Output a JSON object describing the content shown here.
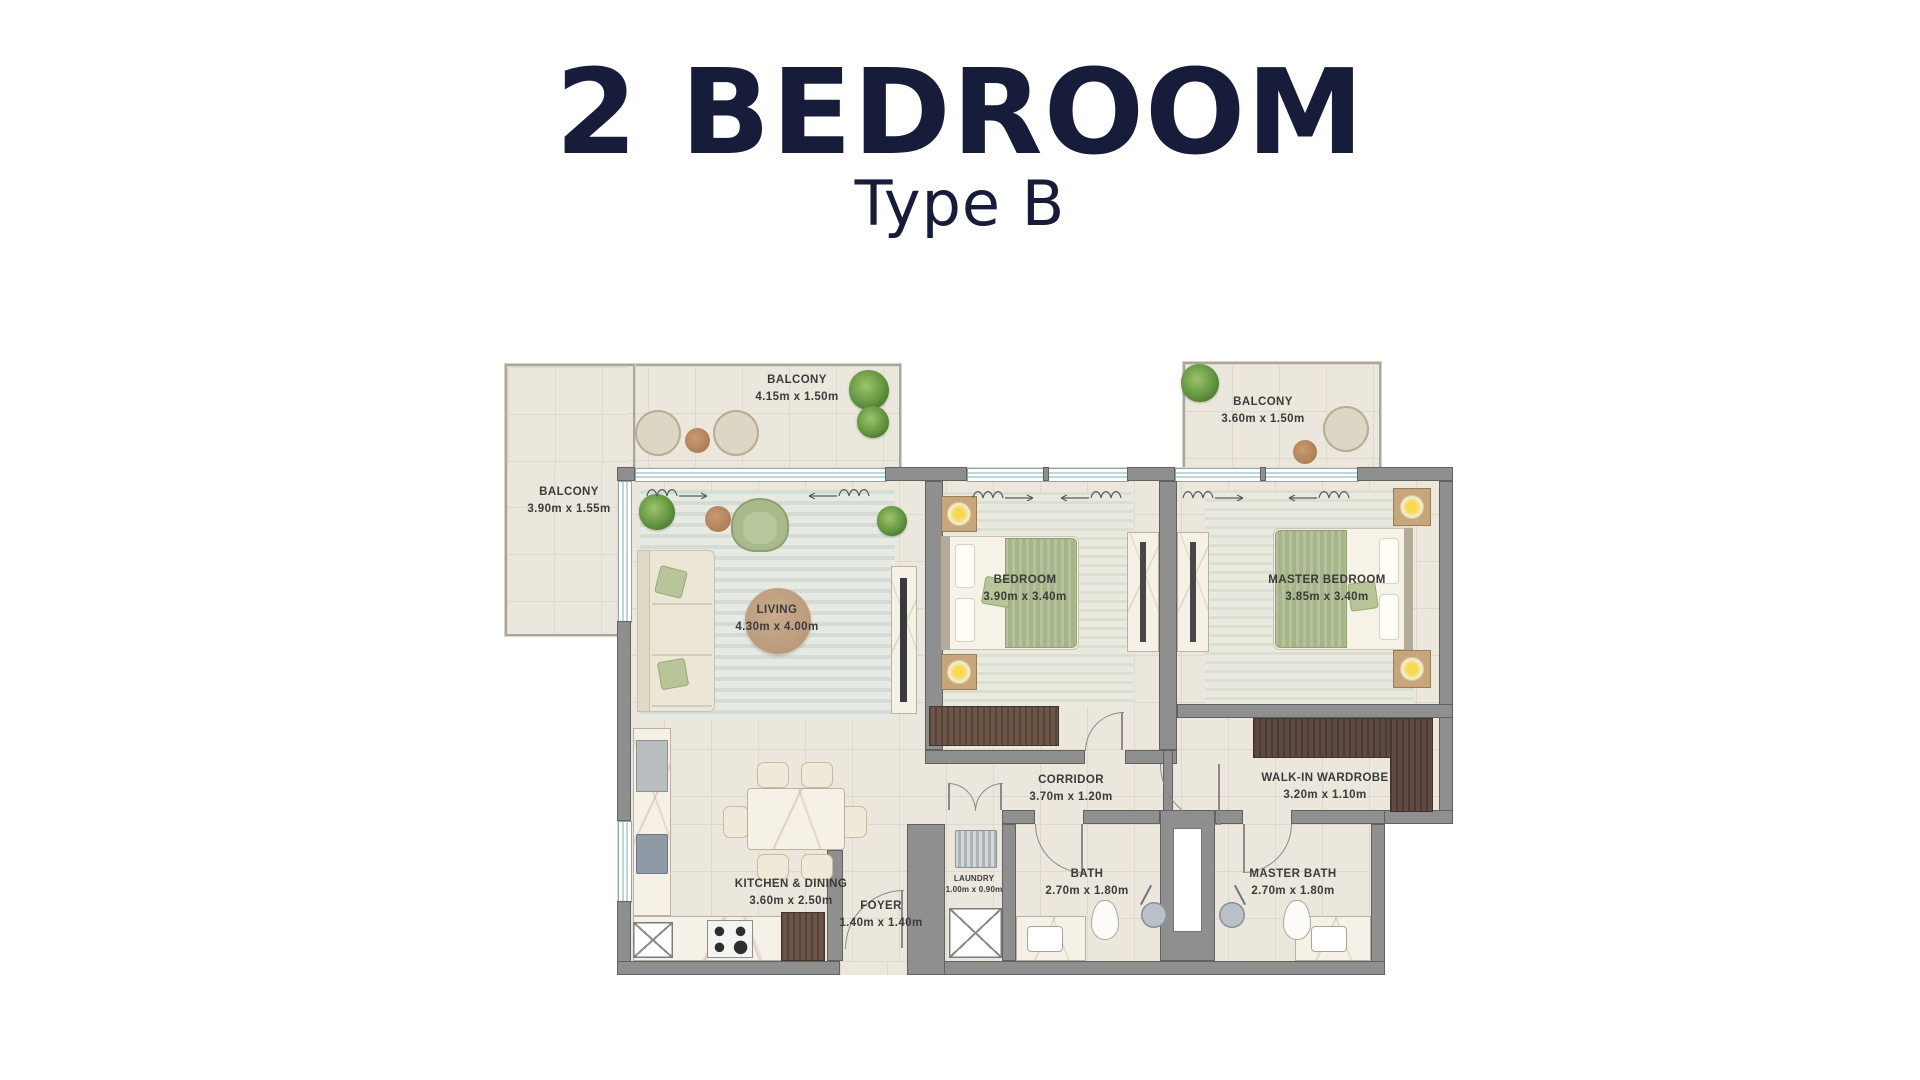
{
  "title": "2 BEDROOM",
  "subtitle": "Type B",
  "palette": {
    "title_navy": "#171c3b",
    "wall_gray": "#8f8f8f",
    "floor_beige": "#ebe7dc",
    "wood_brown": "#5e4a41",
    "accent_green": "#a6b489",
    "glass_blue": "#bcd7da",
    "label_gray": "#3b3b3b"
  },
  "rooms": {
    "balcony_top": {
      "name": "BALCONY",
      "dims": "4.15m x 1.50m"
    },
    "balcony_left": {
      "name": "BALCONY",
      "dims": "3.90m x 1.55m"
    },
    "balcony_right": {
      "name": "BALCONY",
      "dims": "3.60m x 1.50m"
    },
    "living": {
      "name": "LIVING",
      "dims": "4.30m x 4.00m"
    },
    "bedroom": {
      "name": "BEDROOM",
      "dims": "3.90m x 3.40m"
    },
    "master_bedroom": {
      "name": "MASTER BEDROOM",
      "dims": "3.85m x 3.40m"
    },
    "corridor": {
      "name": "CORRIDOR",
      "dims": "3.70m x 1.20m"
    },
    "walk_in_wardrobe": {
      "name": "WALK-IN WARDROBE",
      "dims": "3.20m x 1.10m"
    },
    "kitchen_dining": {
      "name": "KITCHEN & DINING",
      "dims": "3.60m x 2.50m"
    },
    "foyer": {
      "name": "FOYER",
      "dims": "1.40m x 1.40m"
    },
    "laundry": {
      "name": "LAUNDRY",
      "dims": "1.00m x 0.90m"
    },
    "bath": {
      "name": "BATH",
      "dims": "2.70m x 1.80m"
    },
    "master_bath": {
      "name": "MASTER BATH",
      "dims": "2.70m x 1.80m"
    }
  }
}
